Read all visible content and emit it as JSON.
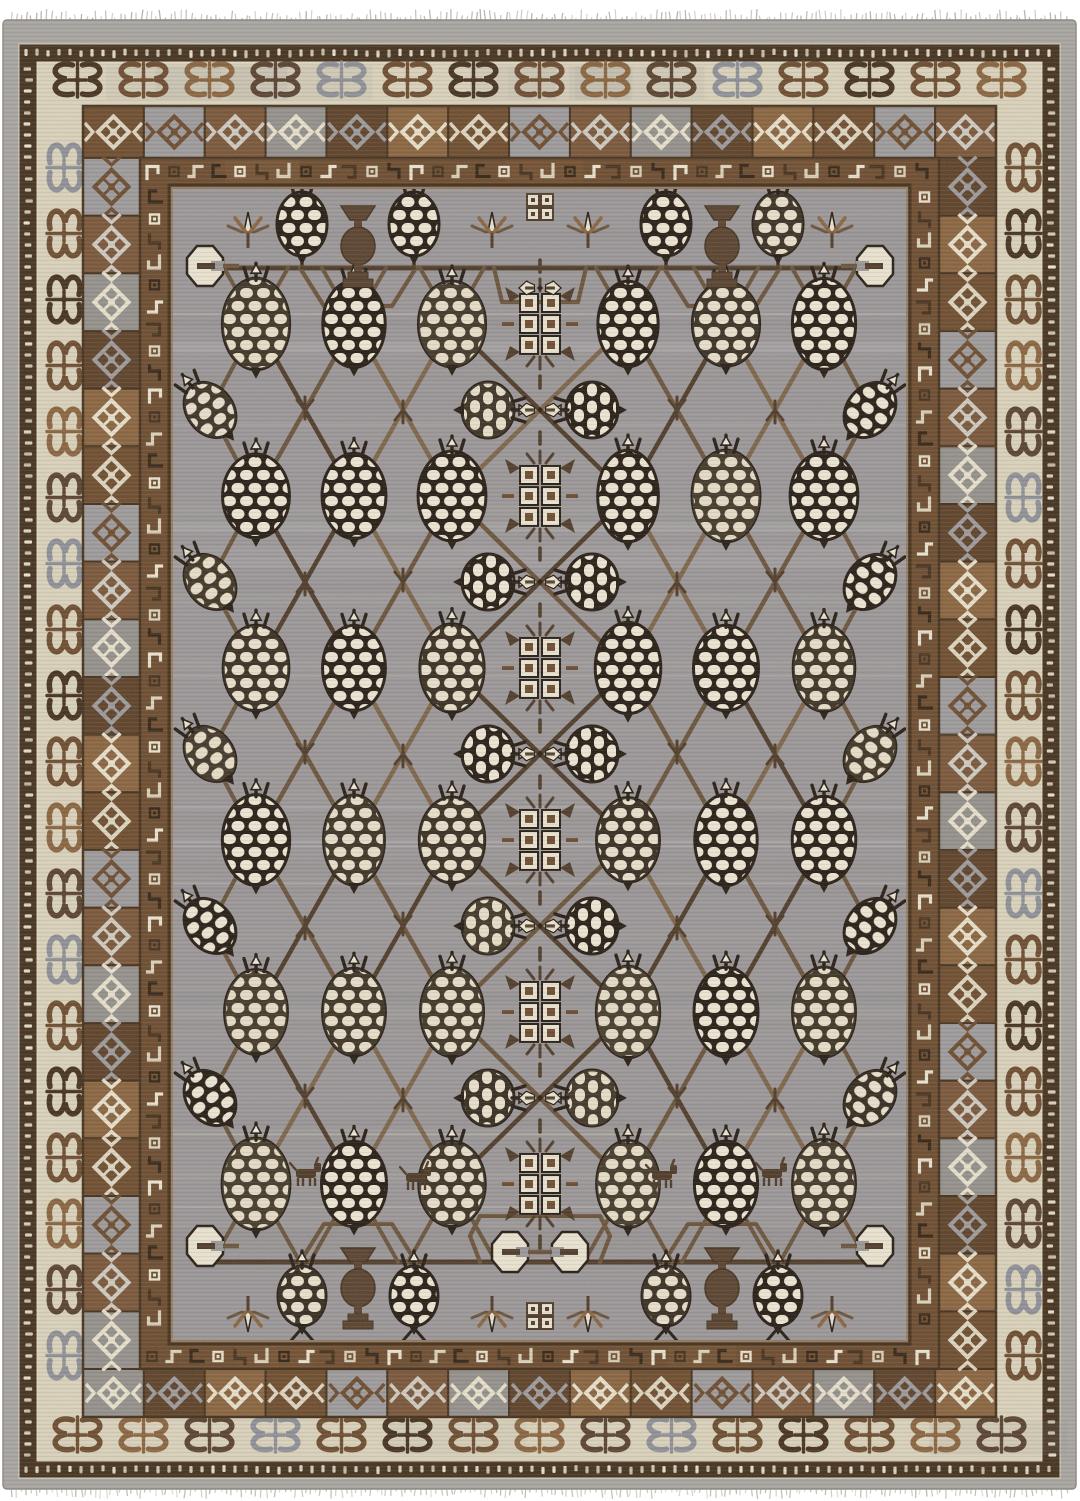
{
  "image": {
    "alt": "Photograph of a hand-knotted Khotan style wool rug with a gray field, ivory pomegranate lattice and brown geometric borders",
    "background": "#ffffff"
  },
  "palette": {
    "bg": "#ffffff",
    "selvage": "#a8a5a0",
    "selvage_edge": "#8f8c86",
    "fringe": "#b5b2ac",
    "dark": "#352718",
    "espresso": "#46331f",
    "brown": "#6d4d30",
    "caramel": "#8a6540",
    "umber": "#5a4330",
    "ivory": "#e9e2cf",
    "parchment": "#d9d1ba",
    "field": "#9b9798",
    "field_light": "#aaa6a4",
    "field_dark": "#8a8688",
    "gray_panel": "#9d9a9b",
    "gray_blue": "#8e9097",
    "vine": "#6b543c",
    "vine_dark": "#503c29",
    "vine_light": "#7d6549",
    "net_dark": "#271e15",
    "pom_ivory": "#ece5d3"
  },
  "rug": {
    "x": 3,
    "y": 20,
    "w": 1073,
    "h": 1469,
    "bands": {
      "selvage": {
        "t": 24,
        "r": 16,
        "b": 11,
        "l": 16
      },
      "dot": {
        "t": 18,
        "r": 18,
        "b": 17,
        "l": 18
      },
      "ivory": {
        "t": 44,
        "r": 46,
        "b": 44,
        "l": 46
      },
      "squares": {
        "t": 52,
        "r": 57,
        "b": 48,
        "l": 57
      },
      "hook": {
        "t": 27,
        "r": 29,
        "b": 25,
        "l": 29
      },
      "sep": 4
    }
  },
  "borders": {
    "butterfly_spacing": 66,
    "panel_size": 59,
    "hook_spacing": 22,
    "dot_spacing": 11,
    "butterfly_colors": [
      "#46331f",
      "#6d4d30",
      "#8a6540",
      "#5a4330",
      "#8e9097",
      "#6d4d30"
    ],
    "panel_bgs": [
      "#6f4e2f",
      "#9d9a9b",
      "#7a573a",
      "#94908c",
      "#5f432a",
      "#8a6540"
    ],
    "panel_fgs": [
      "#ddd5c0",
      "#6d4d30",
      "#cfcac0",
      "#e7dfca",
      "#9d9a9b",
      "#e7dfca"
    ],
    "hook_colors": [
      "#e9e2cf",
      "#46331f",
      "#d9d1ba",
      "#352718"
    ]
  },
  "field_layout": {
    "center_x": 540,
    "pom_cols": [
      256,
      354,
      452,
      628,
      726,
      824
    ],
    "edge_cols": [
      210,
      870
    ],
    "pair_xs": [
      488,
      592
    ],
    "type1_rows": [
      238,
      410,
      582,
      754,
      926,
      1098,
      1270
    ],
    "type2_rows": [
      324,
      496,
      668,
      840,
      1012,
      1184
    ],
    "top_vine_y": 268,
    "bottom_vine_y": 1262,
    "urn_xs": [
      358,
      722
    ],
    "top_pom_xs": [
      302,
      414,
      666,
      778
    ],
    "leaf_xs": [
      248,
      492,
      588,
      832
    ],
    "cross_leaf_xs": [
      305,
      403,
      677,
      775
    ],
    "animal_positions": [
      [
        307,
        1176
      ],
      [
        417,
        1180
      ],
      [
        663,
        1178
      ],
      [
        773,
        1176
      ]
    ],
    "pom_w": 64,
    "pom_h": 88,
    "small_pom_w": 50,
    "small_pom_h": 64
  },
  "fringe": {
    "spacing": 5,
    "top_len": 9,
    "bottom_len": 8
  }
}
